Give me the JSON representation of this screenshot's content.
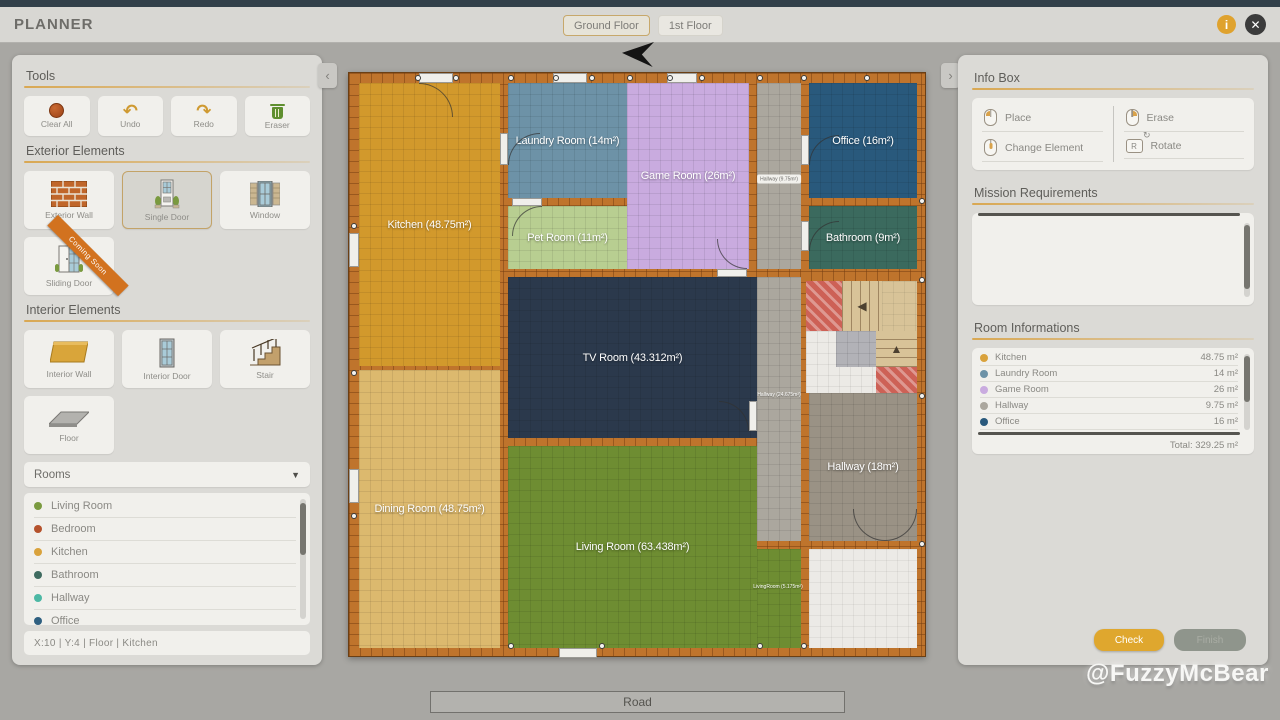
{
  "header": {
    "title": "PLANNER",
    "tabs": [
      {
        "label": "Ground Floor",
        "active": true
      },
      {
        "label": "1st Floor",
        "active": false
      }
    ]
  },
  "sections": {
    "tools": {
      "title": "Tools",
      "items": [
        {
          "label": "Clear All"
        },
        {
          "label": "Undo"
        },
        {
          "label": "Redo"
        },
        {
          "label": "Eraser"
        }
      ]
    },
    "exterior": {
      "title": "Exterior Elements",
      "items": [
        {
          "label": "Exterior Wall"
        },
        {
          "label": "Single Door",
          "selected": true
        },
        {
          "label": "Window"
        },
        {
          "label": "Sliding Door",
          "ribbon": "Coming Soon"
        }
      ]
    },
    "interior": {
      "title": "Interior Elements",
      "items": [
        {
          "label": "Interior Wall"
        },
        {
          "label": "Interior Door"
        },
        {
          "label": "Stair"
        },
        {
          "label": "Floor"
        }
      ]
    }
  },
  "rooms_panel": {
    "dropdown_label": "Rooms",
    "caret": "▼",
    "options": [
      {
        "name": "Living Room",
        "color": "#7a9a3f"
      },
      {
        "name": "Bedroom",
        "color": "#b5522c"
      },
      {
        "name": "Kitchen",
        "color": "#d9a23c"
      },
      {
        "name": "Bathroom",
        "color": "#3f6b60"
      },
      {
        "name": "Hallway",
        "color": "#4cb8a4"
      },
      {
        "name": "Office",
        "color": "#2e5f80"
      }
    ]
  },
  "status_bar": {
    "text": "X:10   |   Y:4   |   Floor   |   Kitchen"
  },
  "info_box": {
    "title": "Info Box",
    "items": [
      {
        "label": "Place",
        "icon": "mouse-left"
      },
      {
        "label": "Erase",
        "icon": "mouse-right"
      },
      {
        "label": "Change Element",
        "icon": "mouse-wheel"
      },
      {
        "label": "Rotate",
        "icon": "key-r",
        "key": "R"
      }
    ]
  },
  "mission": {
    "title": "Mission Requirements"
  },
  "room_info": {
    "title": "Room Informations",
    "rows": [
      {
        "name": "Kitchen",
        "area": "48.75 m²",
        "color": "#d9a23c"
      },
      {
        "name": "Laundry Room",
        "area": "14 m²",
        "color": "#6d92a7"
      },
      {
        "name": "Game Room",
        "area": "26 m²",
        "color": "#c9abdf"
      },
      {
        "name": "Hallway",
        "area": "9.75 m²",
        "color": "#aba79e"
      },
      {
        "name": "Office",
        "area": "16 m²",
        "color": "#29597c"
      }
    ],
    "total": "Total: 329.25 m²"
  },
  "footer": {
    "check": "Check",
    "finish": "Finish"
  },
  "road": {
    "label": "Road"
  },
  "watermark": {
    "text": "@FuzzyMcBear"
  },
  "canvas": {
    "rooms": [
      {
        "id": "kitchen",
        "label": "Kitchen (48.75m²)",
        "x": 10,
        "y": 10,
        "w": 141,
        "h": 283,
        "color": "#d2992c"
      },
      {
        "id": "dining-room",
        "label": "Dining Room (48.75m²)",
        "x": 10,
        "y": 297,
        "w": 141,
        "h": 278,
        "color": "#dcb96e"
      },
      {
        "id": "laundry-room",
        "label": "Laundry Room (14m²)",
        "x": 159,
        "y": 10,
        "w": 119,
        "h": 115,
        "color": "#6d92a7"
      },
      {
        "id": "pet-room",
        "label": "Pet Room (11m²)",
        "x": 159,
        "y": 133,
        "w": 119,
        "h": 63,
        "color": "#b8ce91"
      },
      {
        "id": "game-room",
        "label": "Game Room (26m²)",
        "x": 278,
        "y": 10,
        "w": 122,
        "h": 186,
        "color": "#c9abdf"
      },
      {
        "id": "hallway-top",
        "label": "",
        "x": 408,
        "y": 10,
        "w": 44,
        "h": 186,
        "color": "#aba79e"
      },
      {
        "id": "office",
        "label": "Office (16m²)",
        "x": 460,
        "y": 10,
        "w": 108,
        "h": 115,
        "color": "#29597c"
      },
      {
        "id": "bathroom",
        "label": "Bathroom (9m²)",
        "x": 460,
        "y": 133,
        "w": 108,
        "h": 63,
        "color": "#3b6a5e"
      },
      {
        "id": "tv-room",
        "label": "TV Room (43.312m²)",
        "x": 159,
        "y": 204,
        "w": 249,
        "h": 161,
        "color": "#2b394c"
      },
      {
        "id": "hallway-mid",
        "label": "",
        "x": 408,
        "y": 204,
        "w": 44,
        "h": 264,
        "color": "#aba79e"
      },
      {
        "id": "hallway",
        "label": "Hallway (18m²)",
        "x": 460,
        "y": 320,
        "w": 108,
        "h": 148,
        "color": "#9a9285"
      },
      {
        "id": "living-room",
        "label": "Living Room (63.438m²)",
        "x": 159,
        "y": 373,
        "w": 249,
        "h": 202,
        "color": "#6e8d32"
      },
      {
        "id": "living-strip",
        "label": "",
        "x": 408,
        "y": 476,
        "w": 44,
        "h": 99,
        "color": "#6e8d32"
      },
      {
        "id": "empty-floor",
        "label": "",
        "x": 460,
        "y": 476,
        "w": 108,
        "h": 99,
        "color": "#eceae6",
        "light": true
      }
    ],
    "tiny_labels": [
      {
        "text": "Hallway (9.75m²)",
        "x": 430,
        "y": 106,
        "style": "chip"
      },
      {
        "text": "Hallway (24.675m²)",
        "x": 430,
        "y": 322,
        "style": "plain"
      },
      {
        "text": "LivingRoom (5.175m²)",
        "x": 429,
        "y": 514,
        "style": "plain"
      }
    ],
    "stairs": {
      "x": 452,
      "y": 204,
      "blocks": [
        {
          "x": 5,
          "y": 4,
          "w": 36,
          "h": 50,
          "type": "red"
        },
        {
          "x": 41,
          "y": 4,
          "w": 40,
          "h": 50,
          "type": "tv",
          "arrow": "◀"
        },
        {
          "x": 81,
          "y": 4,
          "w": 35,
          "h": 50,
          "type": "beige"
        },
        {
          "x": 5,
          "y": 54,
          "w": 70,
          "h": 62,
          "type": "white"
        },
        {
          "x": 35,
          "y": 54,
          "w": 40,
          "h": 36,
          "type": "gray"
        },
        {
          "x": 75,
          "y": 54,
          "w": 41,
          "h": 36,
          "type": "th",
          "arrow": "▲"
        },
        {
          "x": 75,
          "y": 90,
          "w": 41,
          "h": 26,
          "type": "red"
        }
      ]
    },
    "openings": [
      {
        "x": 70,
        "y": 0,
        "w": 34,
        "h": 10
      },
      {
        "x": 204,
        "y": 0,
        "w": 34,
        "h": 10
      },
      {
        "x": 318,
        "y": 0,
        "w": 30,
        "h": 10
      },
      {
        "x": 0,
        "y": 160,
        "w": 10,
        "h": 34
      },
      {
        "x": 0,
        "y": 396,
        "w": 10,
        "h": 34
      },
      {
        "x": 210,
        "y": 575,
        "w": 38,
        "h": 10
      },
      {
        "x": 151,
        "y": 60,
        "w": 8,
        "h": 32
      },
      {
        "x": 163,
        "y": 125,
        "w": 30,
        "h": 8
      },
      {
        "x": 452,
        "y": 62,
        "w": 8,
        "h": 30
      },
      {
        "x": 452,
        "y": 148,
        "w": 8,
        "h": 30
      },
      {
        "x": 400,
        "y": 328,
        "w": 8,
        "h": 30
      },
      {
        "x": 368,
        "y": 196,
        "w": 30,
        "h": 8
      }
    ],
    "arcs": [
      {
        "x": 70,
        "y": 10,
        "s": 34,
        "corner": "tr"
      },
      {
        "x": 159,
        "y": 60,
        "s": 32,
        "corner": "tl"
      },
      {
        "x": 163,
        "y": 133,
        "s": 30,
        "corner": "tl"
      },
      {
        "x": 460,
        "y": 62,
        "s": 30,
        "corner": "tl"
      },
      {
        "x": 460,
        "y": 148,
        "s": 30,
        "corner": "tl"
      },
      {
        "x": 370,
        "y": 328,
        "s": 30,
        "corner": "tr"
      },
      {
        "x": 368,
        "y": 166,
        "s": 30,
        "corner": "bl"
      },
      {
        "x": 504,
        "y": 436,
        "s": 32,
        "corner": "bl"
      },
      {
        "x": 536,
        "y": 436,
        "s": 32,
        "corner": "br"
      }
    ],
    "dots": [
      [
        66,
        2
      ],
      [
        104,
        2
      ],
      [
        159,
        2
      ],
      [
        204,
        2
      ],
      [
        240,
        2
      ],
      [
        278,
        2
      ],
      [
        318,
        2
      ],
      [
        350,
        2
      ],
      [
        408,
        2
      ],
      [
        452,
        2
      ],
      [
        515,
        2
      ],
      [
        2,
        150
      ],
      [
        2,
        297
      ],
      [
        2,
        440
      ],
      [
        570,
        125
      ],
      [
        570,
        204
      ],
      [
        570,
        320
      ],
      [
        570,
        468
      ],
      [
        159,
        570
      ],
      [
        250,
        570
      ],
      [
        408,
        570
      ],
      [
        452,
        570
      ]
    ]
  }
}
